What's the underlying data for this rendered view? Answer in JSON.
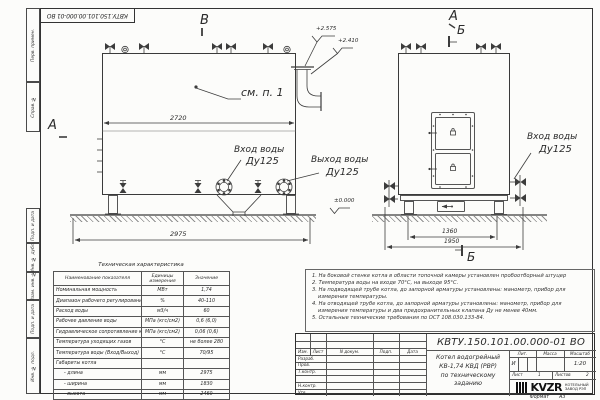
{
  "doc": {
    "number": "КВТУ.150.101.00.000-01 ВО",
    "format_label": "Формат",
    "format_value": "А3"
  },
  "margin": {
    "labels": [
      "Перв. примен.",
      "Справ. №",
      "Подп. и дата",
      "Инв. № дубл.",
      "Взам. инв. №",
      "Подп. и дата",
      "Инв. № подл."
    ]
  },
  "drawing": {
    "view_labels": {
      "v_top": "В",
      "a_left": "А",
      "a_right": "А",
      "b_right": "Б",
      "b_bottom": "Б"
    },
    "see_note": "см. п. 1",
    "elevations": {
      "top1": "+2.575",
      "top2": "+2.410",
      "zero": "±0.000"
    },
    "dimensions": {
      "body_length": "2720",
      "overall_length": "2975",
      "base_width": "1360",
      "overall_width": "1950"
    },
    "ports": {
      "inlet_side_label": "Вход воды",
      "inlet_side_dn": "Ду125",
      "outlet_label": "Выход воды",
      "outlet_dn": "Ду125",
      "inlet_front_label": "Вход воды",
      "inlet_front_dn": "Ду125"
    }
  },
  "tech_table": {
    "title": "Техническая характеристика",
    "headers": [
      "Наименование показателя",
      "Единицы измерения",
      "Значение"
    ],
    "rows": [
      [
        "Номинальная мощность",
        "МВт",
        "1,74"
      ],
      [
        "Диапазон рабочего регулирования",
        "%",
        "40-110"
      ],
      [
        "Расход воды",
        "м3/ч",
        "60"
      ],
      [
        "Рабочее давление воды",
        "МПа (кгс/см2)",
        "0,6 (6,0)"
      ],
      [
        "Гидравлическое сопротивление котла",
        "МПа (кгс/см2)",
        "0,06 (0,6)"
      ],
      [
        "Температура уходящих газов",
        "°С",
        "не более 280"
      ],
      [
        "Температура воды (Вход/Выход)",
        "°С",
        "70/95"
      ],
      [
        "Габариты котла",
        "",
        ""
      ],
      [
        "- длина",
        "мм",
        "2975"
      ],
      [
        "- ширина",
        "мм",
        "1830"
      ],
      [
        "- высота",
        "мм",
        "2460"
      ]
    ]
  },
  "notes": [
    "1. На боковой стенке котла в области топочной камеры установлен пробоотборный штуцер",
    "2. Температура воды на входе 70°С, на выходе 95°С.",
    "3. На подводящей трубе котла, до запорной арматуры установлены: манометр, прибор для измерения температуры.",
    "4. На отводящей трубе котла, до запорной арматуры установлены: манометр, прибор для измерения температуры и два предохранительных клапана Ду не менее 40мм.",
    "5. Остальные технические требования по ОСТ 108.030.133-84."
  ],
  "title_block": {
    "doc_number": "КВТУ.150.101.00.000-01 ВО",
    "columns": [
      "Изм.",
      "Лист",
      "N докум.",
      "Подп.",
      "Дата"
    ],
    "sign_rows": [
      "Разраб.",
      "Пров.",
      "Т.контр.",
      "Н.контр.",
      "Утв."
    ],
    "product_name_lines": [
      "Котел водогрейный",
      "КВ-1,74 КВД (РВР)",
      "по техническому заданию"
    ],
    "lit_header": "Лит.",
    "mass_header": "Масса",
    "scale_header": "Масштаб",
    "lit_value": "И",
    "scale_value": "1:20",
    "sheet_label": "Лист",
    "sheet_number": "1",
    "sheets_label": "Листов",
    "sheets_total": "2",
    "company": {
      "logo": "KVZR",
      "line1": "КОТЕЛЬНЫЙ",
      "line2": "ЗАВОД РЭП"
    }
  }
}
